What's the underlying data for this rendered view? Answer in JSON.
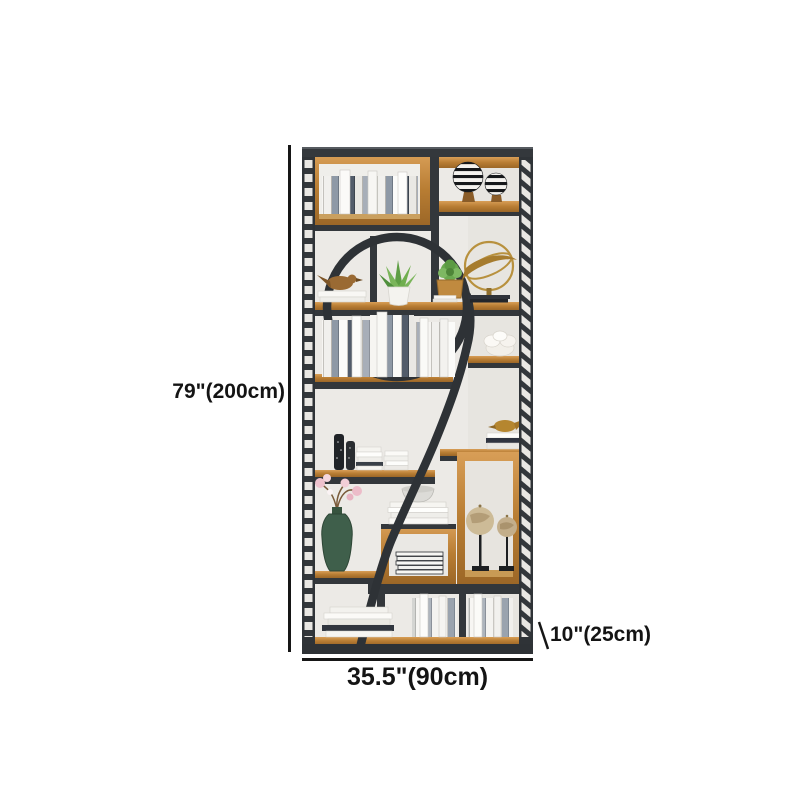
{
  "image": {
    "type": "product-photo",
    "subject": "2-shaped industrial metal and wood bookshelf etagere with decor"
  },
  "dimensions": {
    "height": "79\"(200cm)",
    "width": "35.5\"(90cm)",
    "depth": "10\"(25cm)"
  },
  "colors": {
    "background": "#ffffff",
    "annotation": "#161616",
    "frame": "#33373b",
    "wood": "#b87d33",
    "wall": "#eceae6",
    "plant_green": "#61a148",
    "gold": "#b8913e"
  },
  "decor": {
    "top_left": "books-in-wood-box",
    "top_right": "striped-sphere-ornaments",
    "arch": [
      "bird-figurine-on-books",
      "aloe-plant-in-pot",
      "succulent-in-planter",
      "gold-armillary-ornament"
    ],
    "middle": "row-of-books",
    "middle_right": "white-flower-ornament",
    "lower_left": [
      "black-vases",
      "stacked-white-books",
      "green-vase-with-magnolia"
    ],
    "lower_right": [
      "gold-bird-on-books",
      "globes-on-stands",
      "bowl-on-stacked-books",
      "striped-books-in-box"
    ],
    "bottom": "rows-of-white-books"
  }
}
